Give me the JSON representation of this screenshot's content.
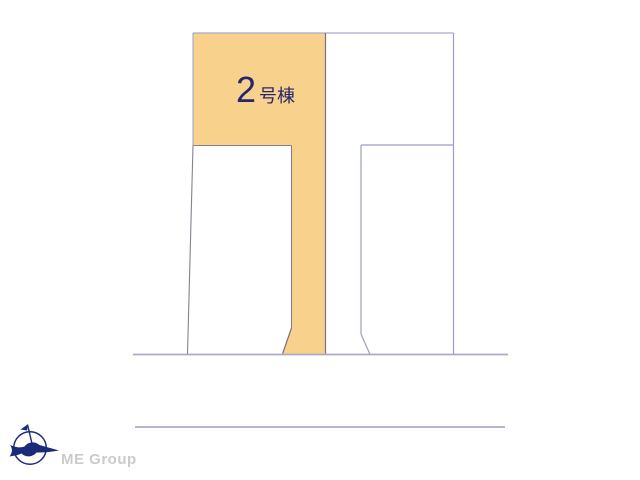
{
  "diagram": {
    "highlighted_plot_label": {
      "number": "2",
      "suffix": "号棟"
    },
    "colors": {
      "highlight_fill": "#F8D28C",
      "label_text": "#26256D",
      "boundary_light": "#A9ABCE",
      "boundary_mid": "#9B9EC6",
      "boundary_dark": "#77737F",
      "road_line": "#A8AAC8"
    }
  },
  "branding": {
    "company": "ME Group",
    "logo_color": "#1B2B79",
    "text_color": "#CBCBCB"
  }
}
